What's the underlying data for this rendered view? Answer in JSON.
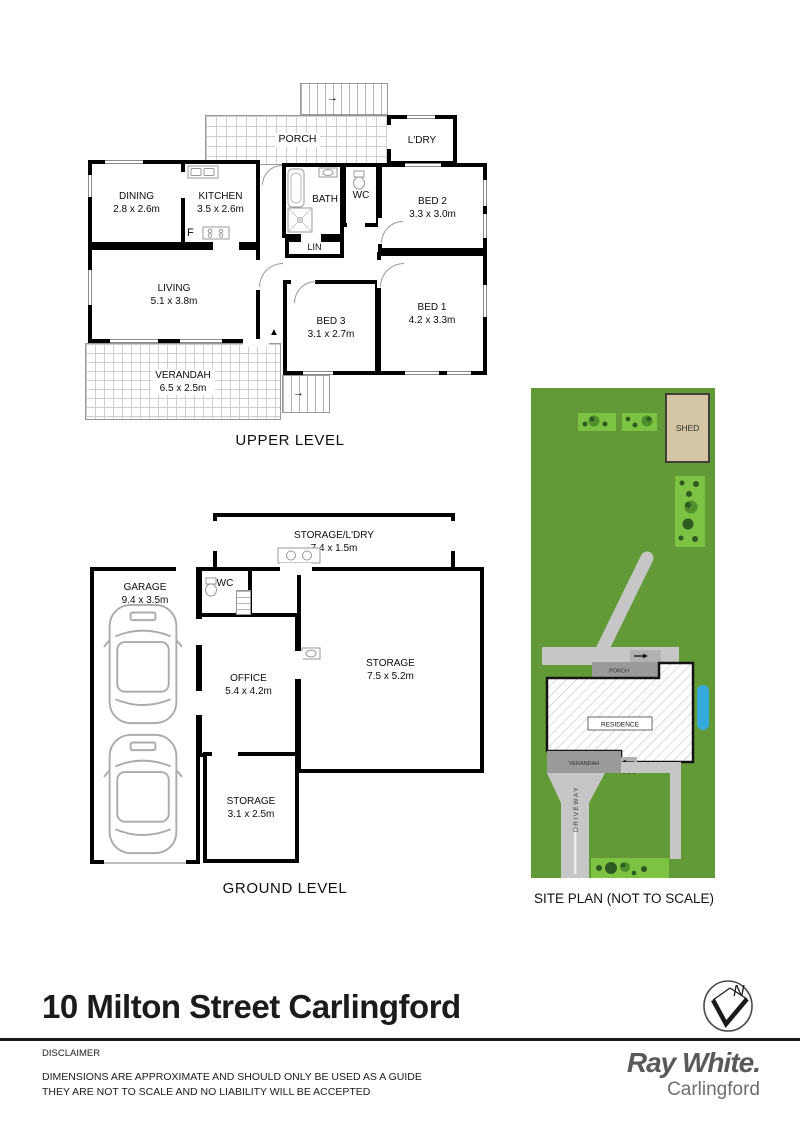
{
  "upper": {
    "caption": "UPPER LEVEL",
    "porch": "PORCH",
    "ldry": "L'DRY",
    "dining_name": "DINING",
    "dining_dims": "2.8 x 2.6m",
    "kitchen_name": "KITCHEN",
    "kitchen_dims": "3.5 x 2.6m",
    "fridge": "F",
    "bath": "BATH",
    "wc": "WC",
    "bed2_name": "BED 2",
    "bed2_dims": "3.3 x 3.0m",
    "lin": "LIN",
    "living_name": "LIVING",
    "living_dims": "5.1 x 3.8m",
    "bed3_name": "BED 3",
    "bed3_dims": "3.1 x 2.7m",
    "bed1_name": "BED 1",
    "bed1_dims": "4.2 x 3.3m",
    "verandah_name": "VERANDAH",
    "verandah_dims": "6.5 x 2.5m"
  },
  "ground": {
    "caption": "GROUND LEVEL",
    "storage_ldry_name": "STORAGE/L'DRY",
    "storage_ldry_dims": "7.4 x 1.5m",
    "garage_name": "GARAGE",
    "garage_dims": "9.4 x 3.5m",
    "wc": "WC",
    "office_name": "OFFICE",
    "office_dims": "5.4 x 4.2m",
    "storage_large_name": "STORAGE",
    "storage_large_dims": "7.5 x 5.2m",
    "storage_small_name": "STORAGE",
    "storage_small_dims": "3.1 x 2.5m"
  },
  "site": {
    "caption": "SITE PLAN (NOT TO SCALE)",
    "shed": "SHED",
    "porch": "PORCH",
    "residence": "RESIDENCE",
    "verandah": "VERANDAH",
    "driveway": "DRIVEWAY",
    "colors": {
      "grass": "#639a38",
      "garden_bed": "#7dc242",
      "bush_dark": "#2d5a20",
      "bush_light": "#4e8f2c",
      "path": "#c6c6c6",
      "structure_grey": "#9a9a9a",
      "shed_fill": "#d4c6a4",
      "water_blue": "#35aadc"
    }
  },
  "icons": {
    "arrow_right": "→",
    "arrow_left": "←",
    "arrow_up": "▲"
  },
  "footer": {
    "address": "10 Milton Street Carlingford",
    "disclaimer_title": "DISCLAIMER",
    "disclaimer_line1": "DIMENSIONS ARE APPROXIMATE AND SHOULD ONLY BE USED AS A GUIDE",
    "disclaimer_line2": "THEY ARE NOT TO SCALE AND NO LIABILITY WILL BE ACCEPTED",
    "north": "N",
    "brand_name": "Ray White",
    "brand_dot": ".",
    "brand_office": "Carlingford"
  }
}
